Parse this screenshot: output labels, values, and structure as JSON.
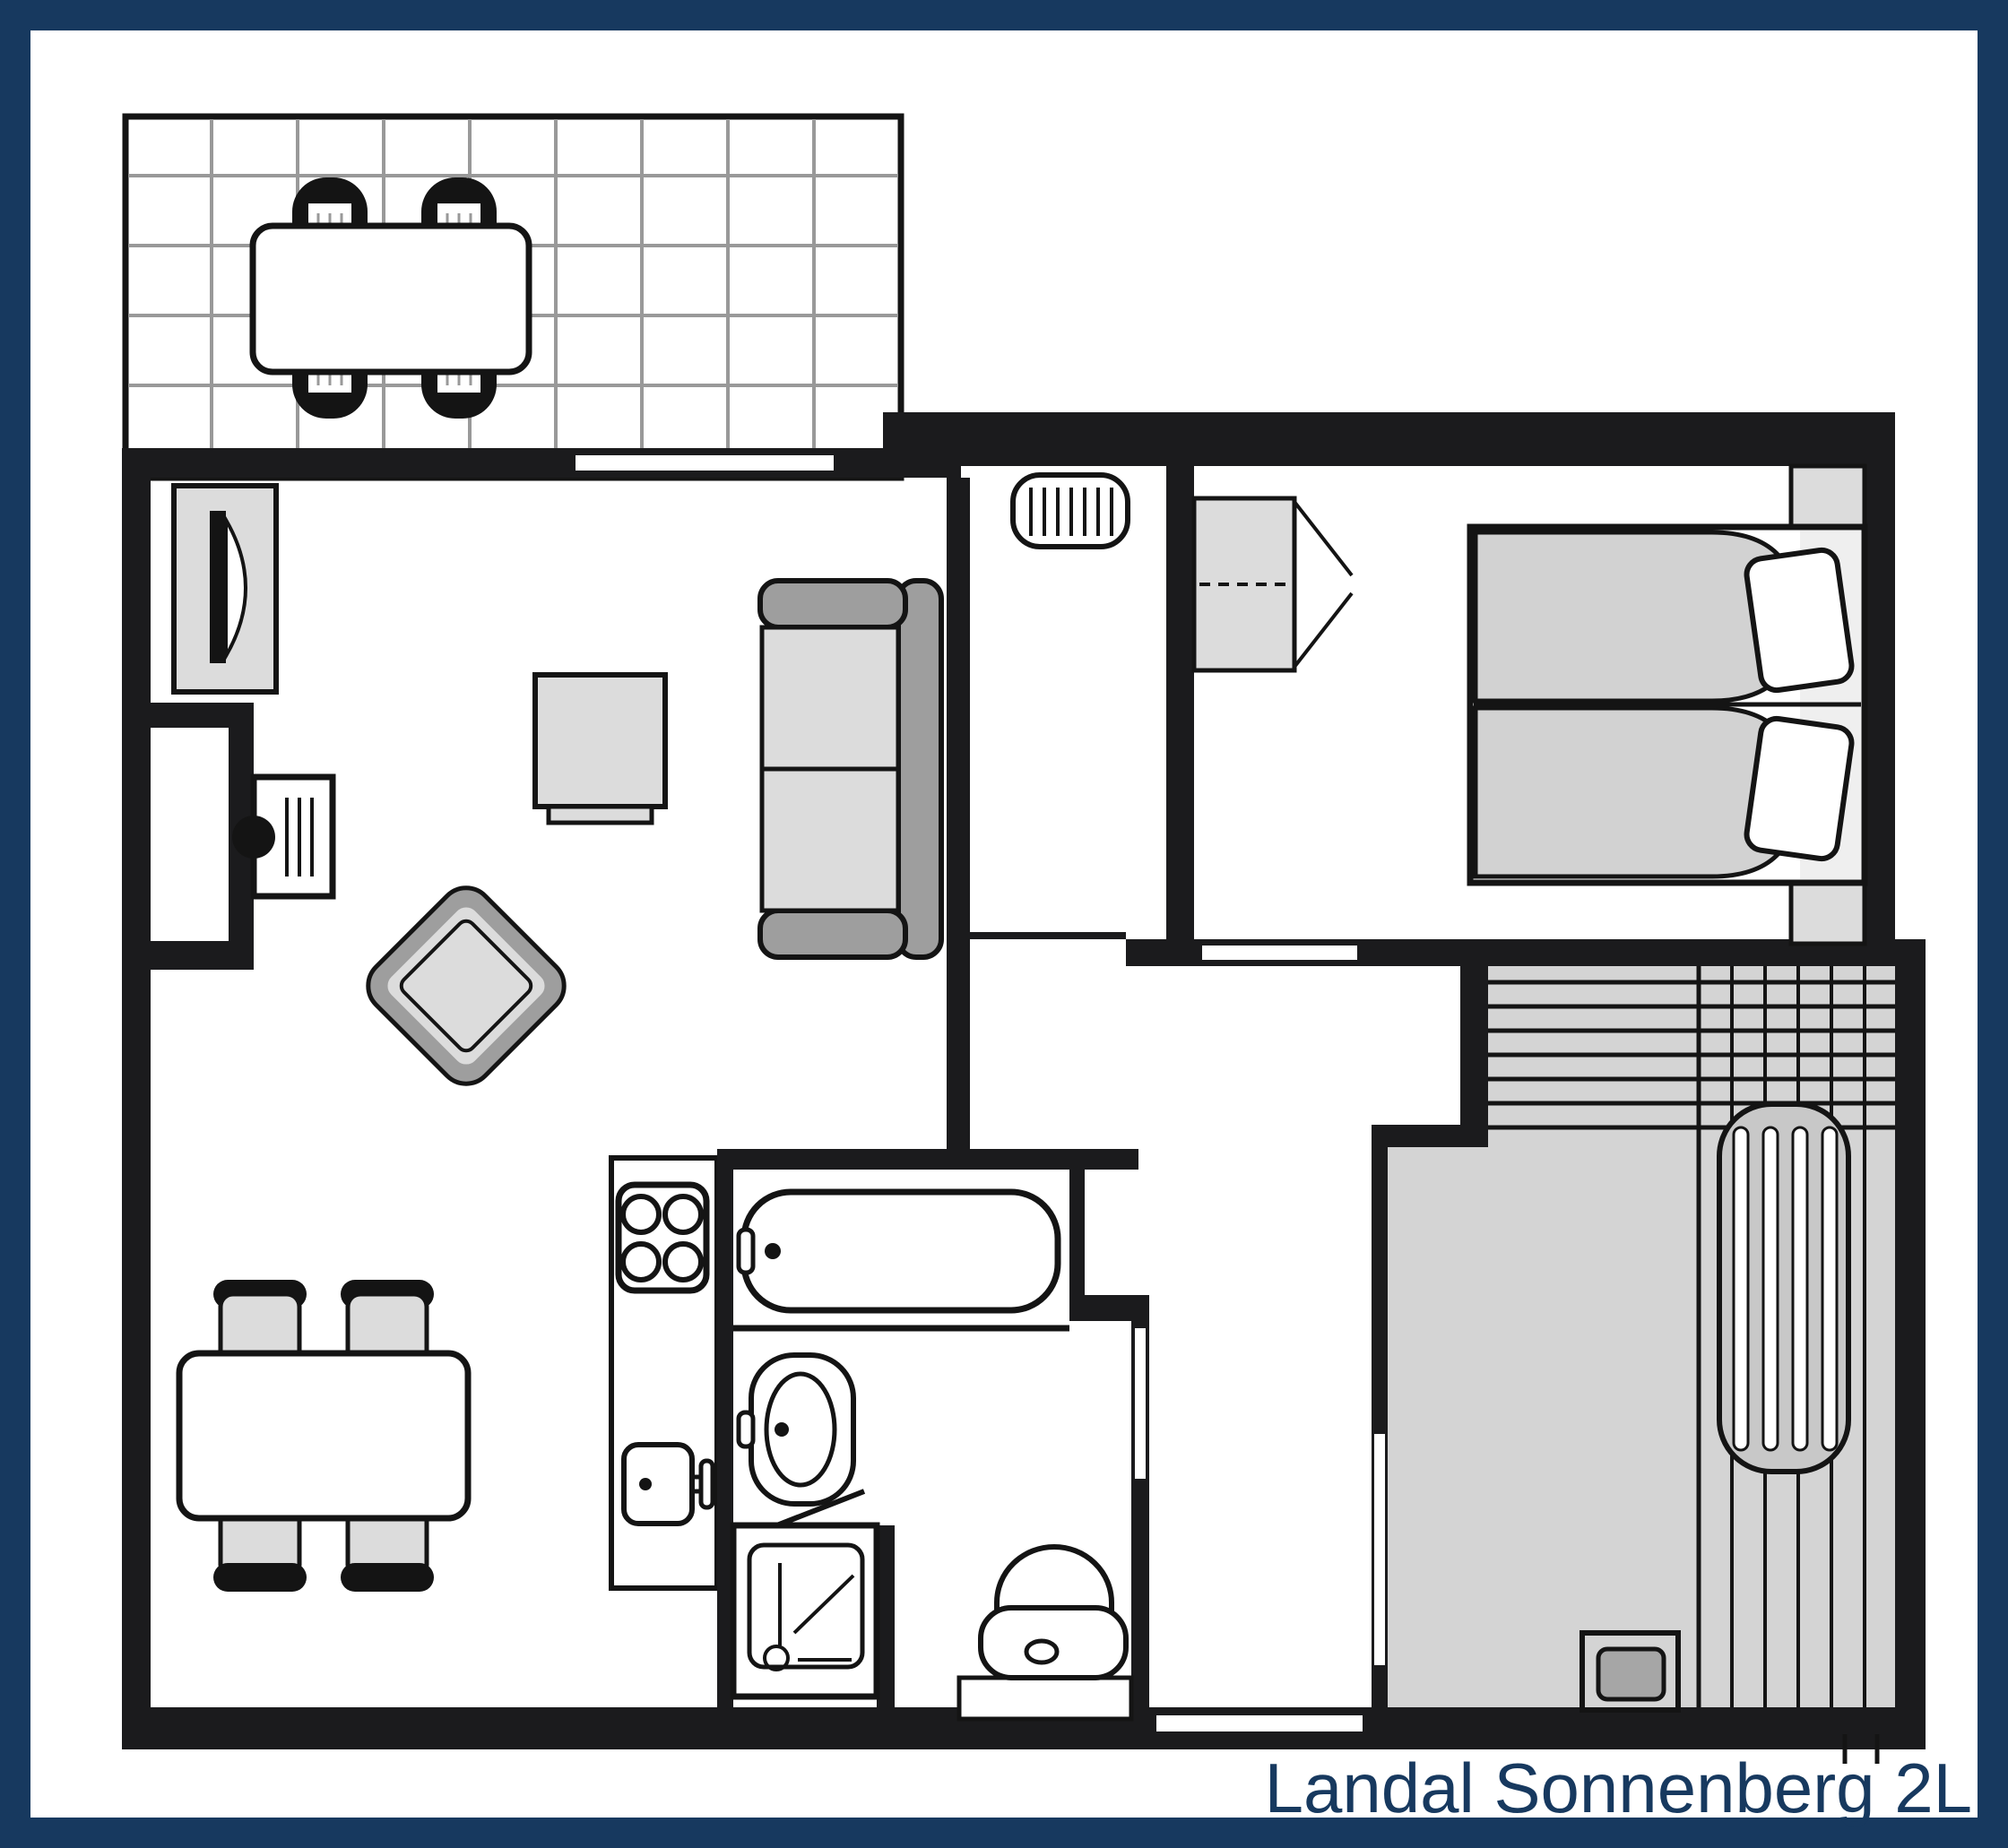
{
  "caption": "Landal Sonnenberg 2L",
  "colors": {
    "navy": "#17395F",
    "wall": "#1B1B1D",
    "line": "#141414",
    "paper": "#FFFFFF",
    "tile": "#999999",
    "lightgray": "#DCDCDC",
    "midgray": "#C8C8C8",
    "darkgray": "#9E9E9E",
    "mattress": "#D2D2D2",
    "roomgray": "#D4D4D4",
    "bedhead": "#EFEFEF",
    "draininner": "#A6A6A6"
  },
  "fixtures": [
    "terrace-tiles",
    "terrace-table",
    "terrace-chairs",
    "patio-sliding-door",
    "tv-cabinet",
    "fireplace",
    "wood-stove",
    "coffee-table",
    "sofa",
    "armchair",
    "dining-table",
    "dining-chairs",
    "kitchen-counter",
    "stove-hob",
    "kitchen-sink",
    "radiator",
    "wardrobe",
    "double-bed",
    "pillows",
    "nightstands",
    "bathtub",
    "washbasin",
    "shower",
    "toilet",
    "sauna-room",
    "lounger",
    "sauna-heater"
  ]
}
